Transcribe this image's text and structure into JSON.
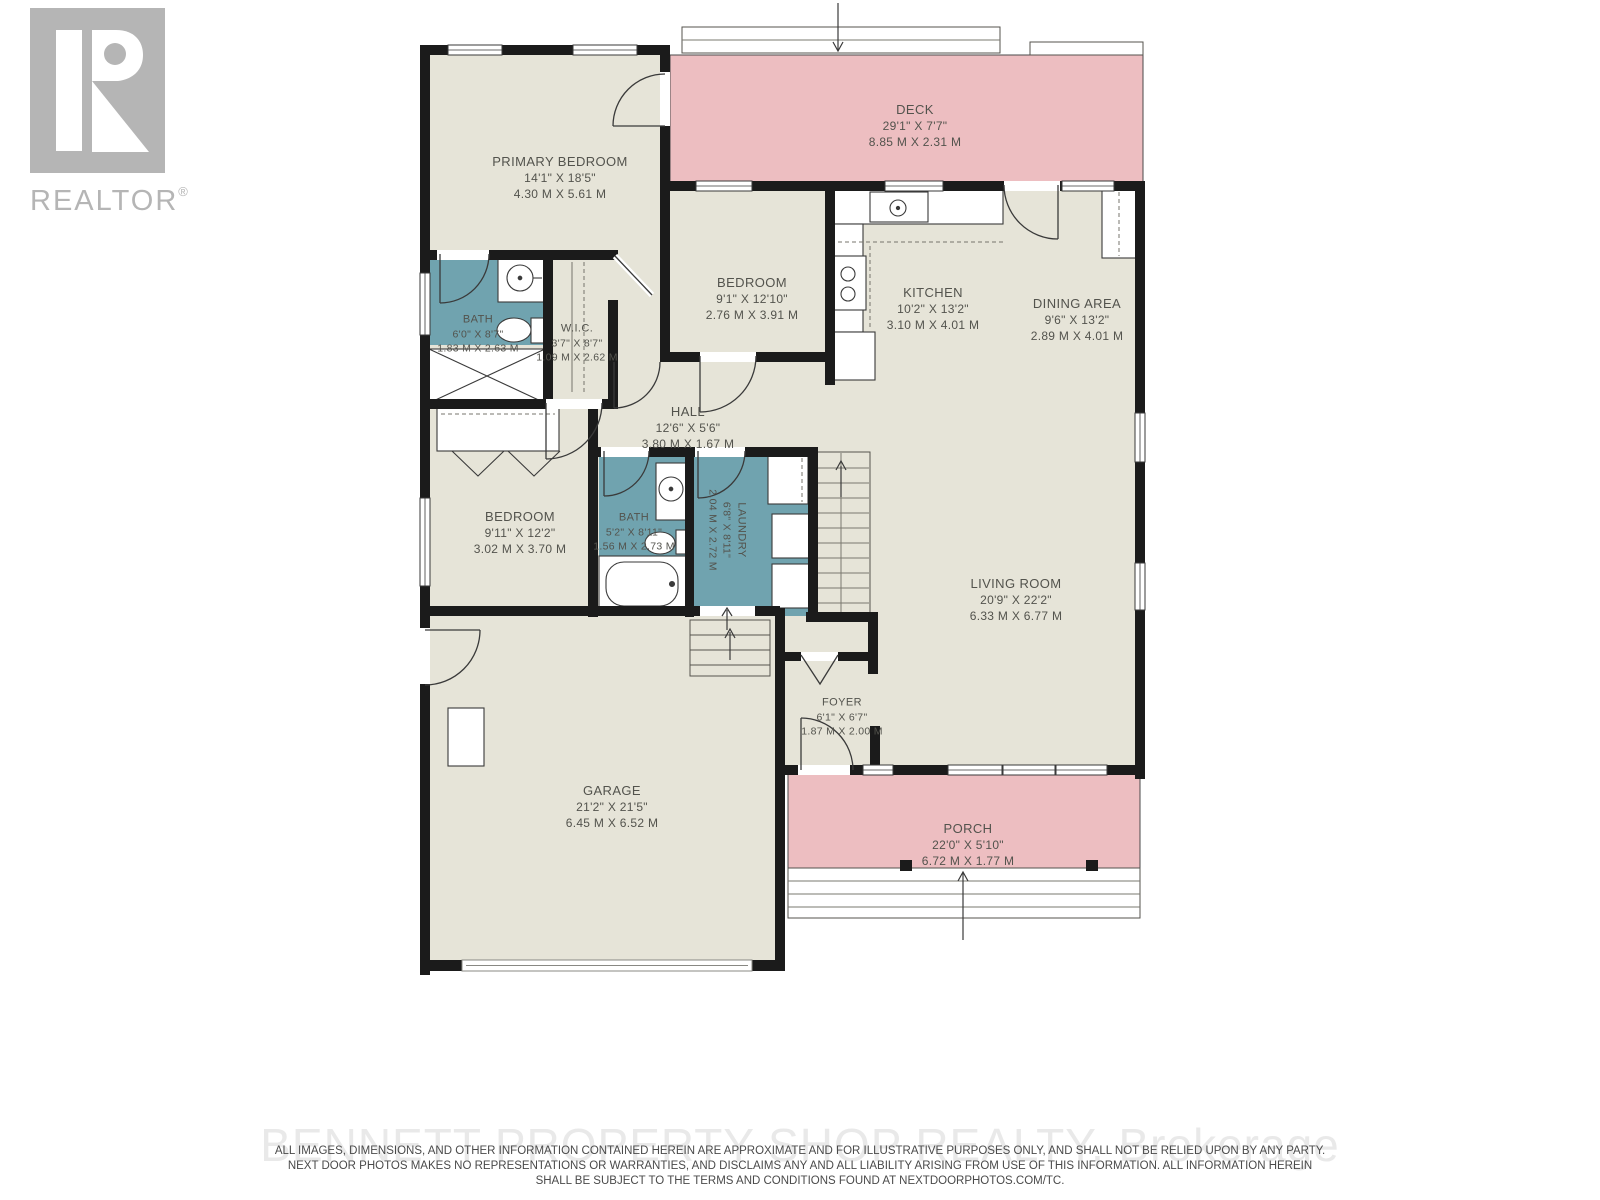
{
  "logo": {
    "brand": "REALTOR",
    "registered": "®"
  },
  "colors": {
    "wall": "#1b1b1b",
    "floor": "#e6e4d8",
    "wet_room_teal": "#70a3af",
    "outdoor_pink": "#edbec1",
    "label_text": "#53534d",
    "logo_gray": "#b5b5b5"
  },
  "rooms": [
    {
      "id": "deck",
      "name": "DECK",
      "imperial": "29'1\" X 7'7\"",
      "metric": "8.85 M X 2.31 M"
    },
    {
      "id": "primary-bedroom",
      "name": "PRIMARY BEDROOM",
      "imperial": "14'1\" X 18'5\"",
      "metric": "4.30 M X 5.61 M"
    },
    {
      "id": "bath-primary",
      "name": "BATH",
      "imperial": "6'0\" X 8'7\"",
      "metric": "1.83 M X 2.63 M"
    },
    {
      "id": "wic",
      "name": "W.I.C.",
      "imperial": "3'7\" X 8'7\"",
      "metric": "1.09 M X 2.62 M"
    },
    {
      "id": "bedroom-2",
      "name": "BEDROOM",
      "imperial": "9'1\" X 12'10\"",
      "metric": "2.76 M X 3.91 M"
    },
    {
      "id": "kitchen",
      "name": "KITCHEN",
      "imperial": "10'2\" X 13'2\"",
      "metric": "3.10 M X 4.01 M"
    },
    {
      "id": "dining-area",
      "name": "DINING AREA",
      "imperial": "9'6\" X 13'2\"",
      "metric": "2.89 M X 4.01 M"
    },
    {
      "id": "hall",
      "name": "HALL",
      "imperial": "12'6\" X 5'6\"",
      "metric": "3.80 M X 1.67 M"
    },
    {
      "id": "bedroom-3",
      "name": "BEDROOM",
      "imperial": "9'11\" X 12'2\"",
      "metric": "3.02 M X 3.70 M"
    },
    {
      "id": "bath-main",
      "name": "BATH",
      "imperial": "5'2\" X 8'11\"",
      "metric": "1.56 M X 2.73 M"
    },
    {
      "id": "laundry",
      "name": "LAUNDRY",
      "imperial": "6'8\" X 8'11\"",
      "metric": "2.04 M X 2.72 M"
    },
    {
      "id": "living-room",
      "name": "LIVING ROOM",
      "imperial": "20'9\" X 22'2\"",
      "metric": "6.33 M X 6.77 M"
    },
    {
      "id": "foyer",
      "name": "FOYER",
      "imperial": "6'1\" X 6'7\"",
      "metric": "1.87 M X 2.00 M"
    },
    {
      "id": "garage",
      "name": "GARAGE",
      "imperial": "21'2\" X 21'5\"",
      "metric": "6.45 M X 6.52 M"
    },
    {
      "id": "porch",
      "name": "PORCH",
      "imperial": "22'0\" X 5'10\"",
      "metric": "6.72 M X 1.77 M"
    }
  ],
  "footer": {
    "watermark": "BENNETT PROPERTY SHOP REALTY, Brokerage",
    "disclaimer": [
      "ALL IMAGES, DIMENSIONS, AND OTHER INFORMATION CONTAINED HEREIN ARE APPROXIMATE AND FOR ILLUSTRATIVE PURPOSES ONLY, AND SHALL NOT BE RELIED UPON BY ANY PARTY.",
      "NEXT DOOR PHOTOS MAKES NO REPRESENTATIONS OR WARRANTIES, AND DISCLAIMS ANY AND ALL LIABILITY ARISING FROM USE OF THIS INFORMATION. ALL INFORMATION HEREIN",
      "SHALL BE SUBJECT TO THE TERMS AND CONDITIONS FOUND AT NEXTDOORPHOTOS.COM/TC."
    ]
  }
}
